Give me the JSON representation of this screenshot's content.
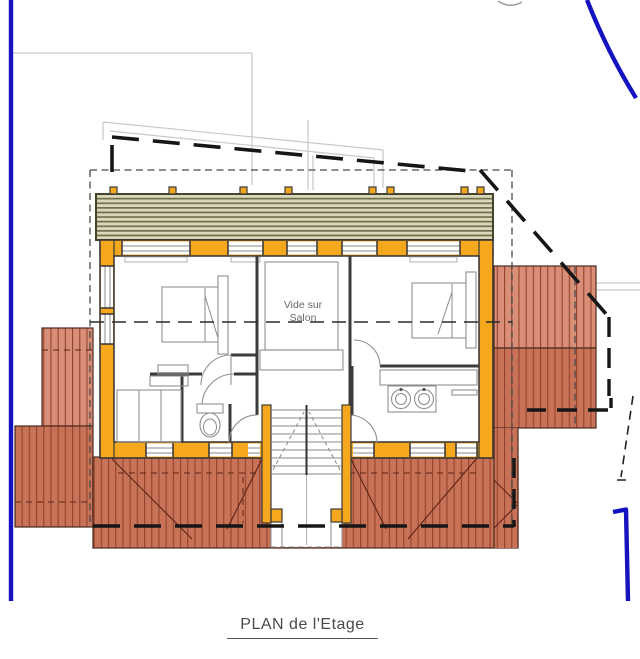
{
  "plan": {
    "void_label": {
      "line1": "Vide sur",
      "line2": "Salon"
    },
    "caption": "PLAN de l'Etage"
  },
  "colors": {
    "wall-orange": "#F5A71E",
    "deck-bg": "#DBD7BA",
    "deck-line": "#70704F",
    "roof-light": "#D98E77",
    "roof-dark": "#C87257",
    "roof-stripe": "#94432C",
    "roof-outline": "#4A2A1E",
    "blue-line": "#1512C0",
    "dash-heavy": "#161616",
    "dash-fine": "#4A4A4A",
    "wall-dark": "#3B3B3B",
    "furniture-gray": "#8F8F8F",
    "faint-gray": "#C9C9C9",
    "text-gray": "#686868",
    "title-gray": "#4A4A4A"
  }
}
